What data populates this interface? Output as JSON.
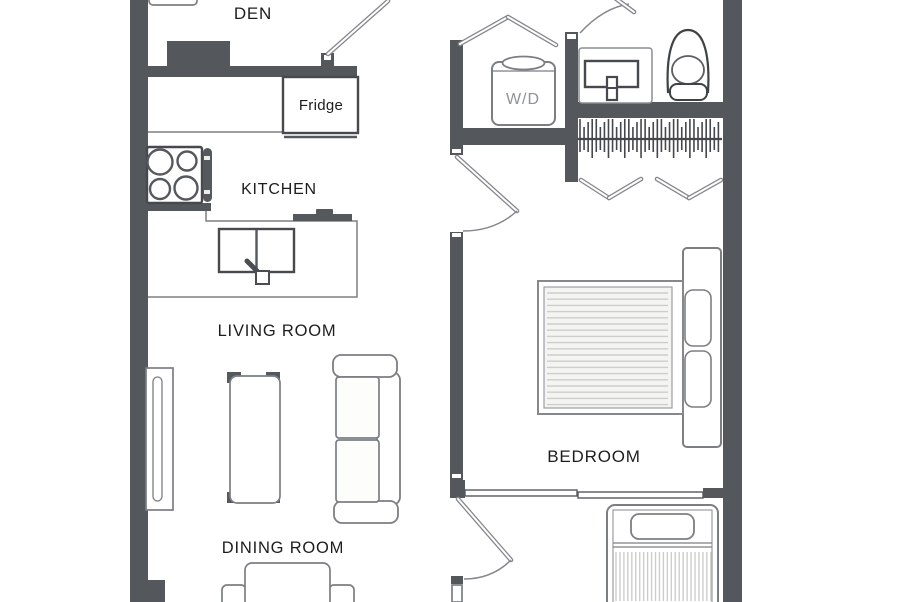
{
  "floor_plan": {
    "labels": {
      "den": "DEN",
      "kitchen": "KITCHEN",
      "living_room": "LIVING ROOM",
      "dining_room": "DINING ROOM",
      "bedroom": "BEDROOM",
      "fridge": "Fridge",
      "washer_dryer": "W/D"
    },
    "fixtures": [
      "stove-cooktop-icon",
      "double-basin-sink-icon",
      "fridge-icon",
      "washer-dryer-icon",
      "bathroom-vanity-sink-icon",
      "toilet-icon",
      "closet-hanging-rod-icon",
      "bifold-closet-door-icon",
      "hinged-door-icon",
      "sliding-door-icon",
      "double-bed-icon",
      "single-bed-icon",
      "headboard-icon",
      "pillow-icon",
      "sofa-icon",
      "coffee-table-icon",
      "tv-console-icon",
      "dining-table-icon",
      "dining-chair-icon",
      "desk-icon"
    ],
    "colors": {
      "wall": "#54575c",
      "outline": "#7b7e83",
      "fixture_dark": "#46494e",
      "label_text": "#1d1d1f",
      "wd_label": "#8f9297",
      "stripe": "#cdcdca",
      "background": "#ffffff"
    }
  }
}
